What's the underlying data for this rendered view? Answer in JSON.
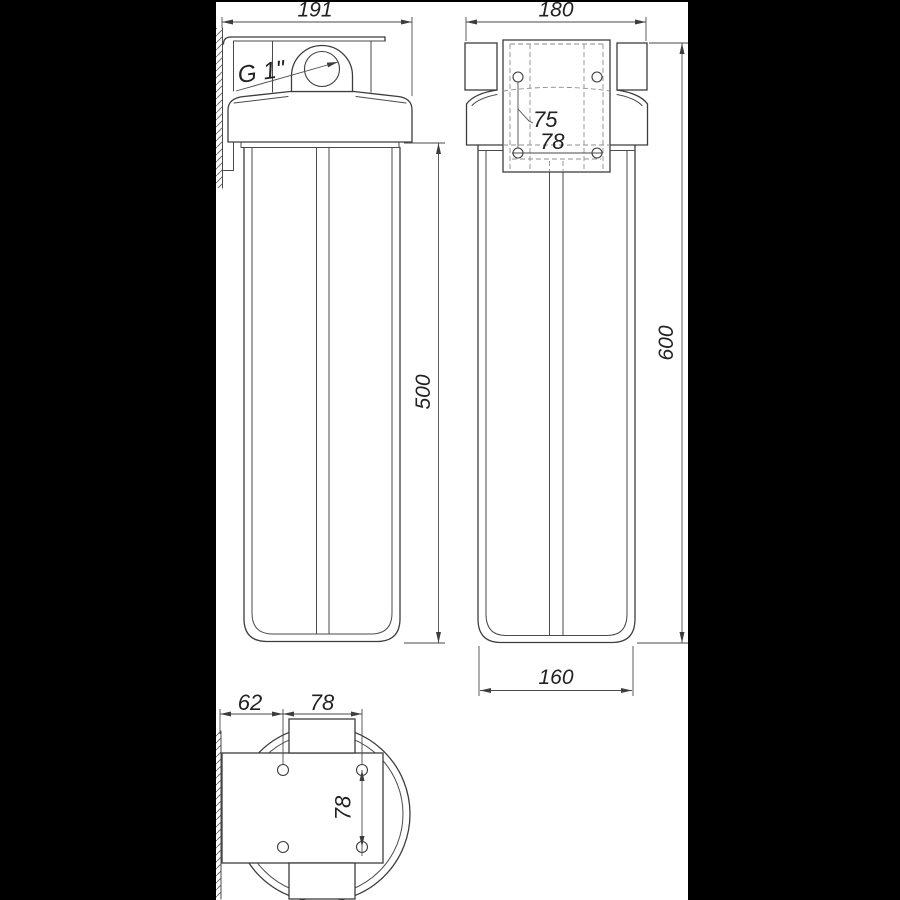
{
  "drawing": {
    "title": "filter-housing-dimension-drawing",
    "colors": {
      "background": "#ffffff",
      "line": "#3d3d3d",
      "frame": "#000000"
    },
    "views": {
      "front": {
        "dims": {
          "overall_width": "191",
          "thread_size": "G 1\"",
          "sump_height": "500"
        }
      },
      "side": {
        "dims": {
          "overall_depth": "180",
          "bracket_hole_spacing_vertical": "75",
          "bracket_hole_spacing_horizontal": "78",
          "overall_height": "600",
          "sump_width": "160"
        }
      },
      "bottom": {
        "dims": {
          "wall_to_hole": "62",
          "hole_spacing_width": "78",
          "hole_spacing_depth": "78"
        }
      }
    }
  }
}
